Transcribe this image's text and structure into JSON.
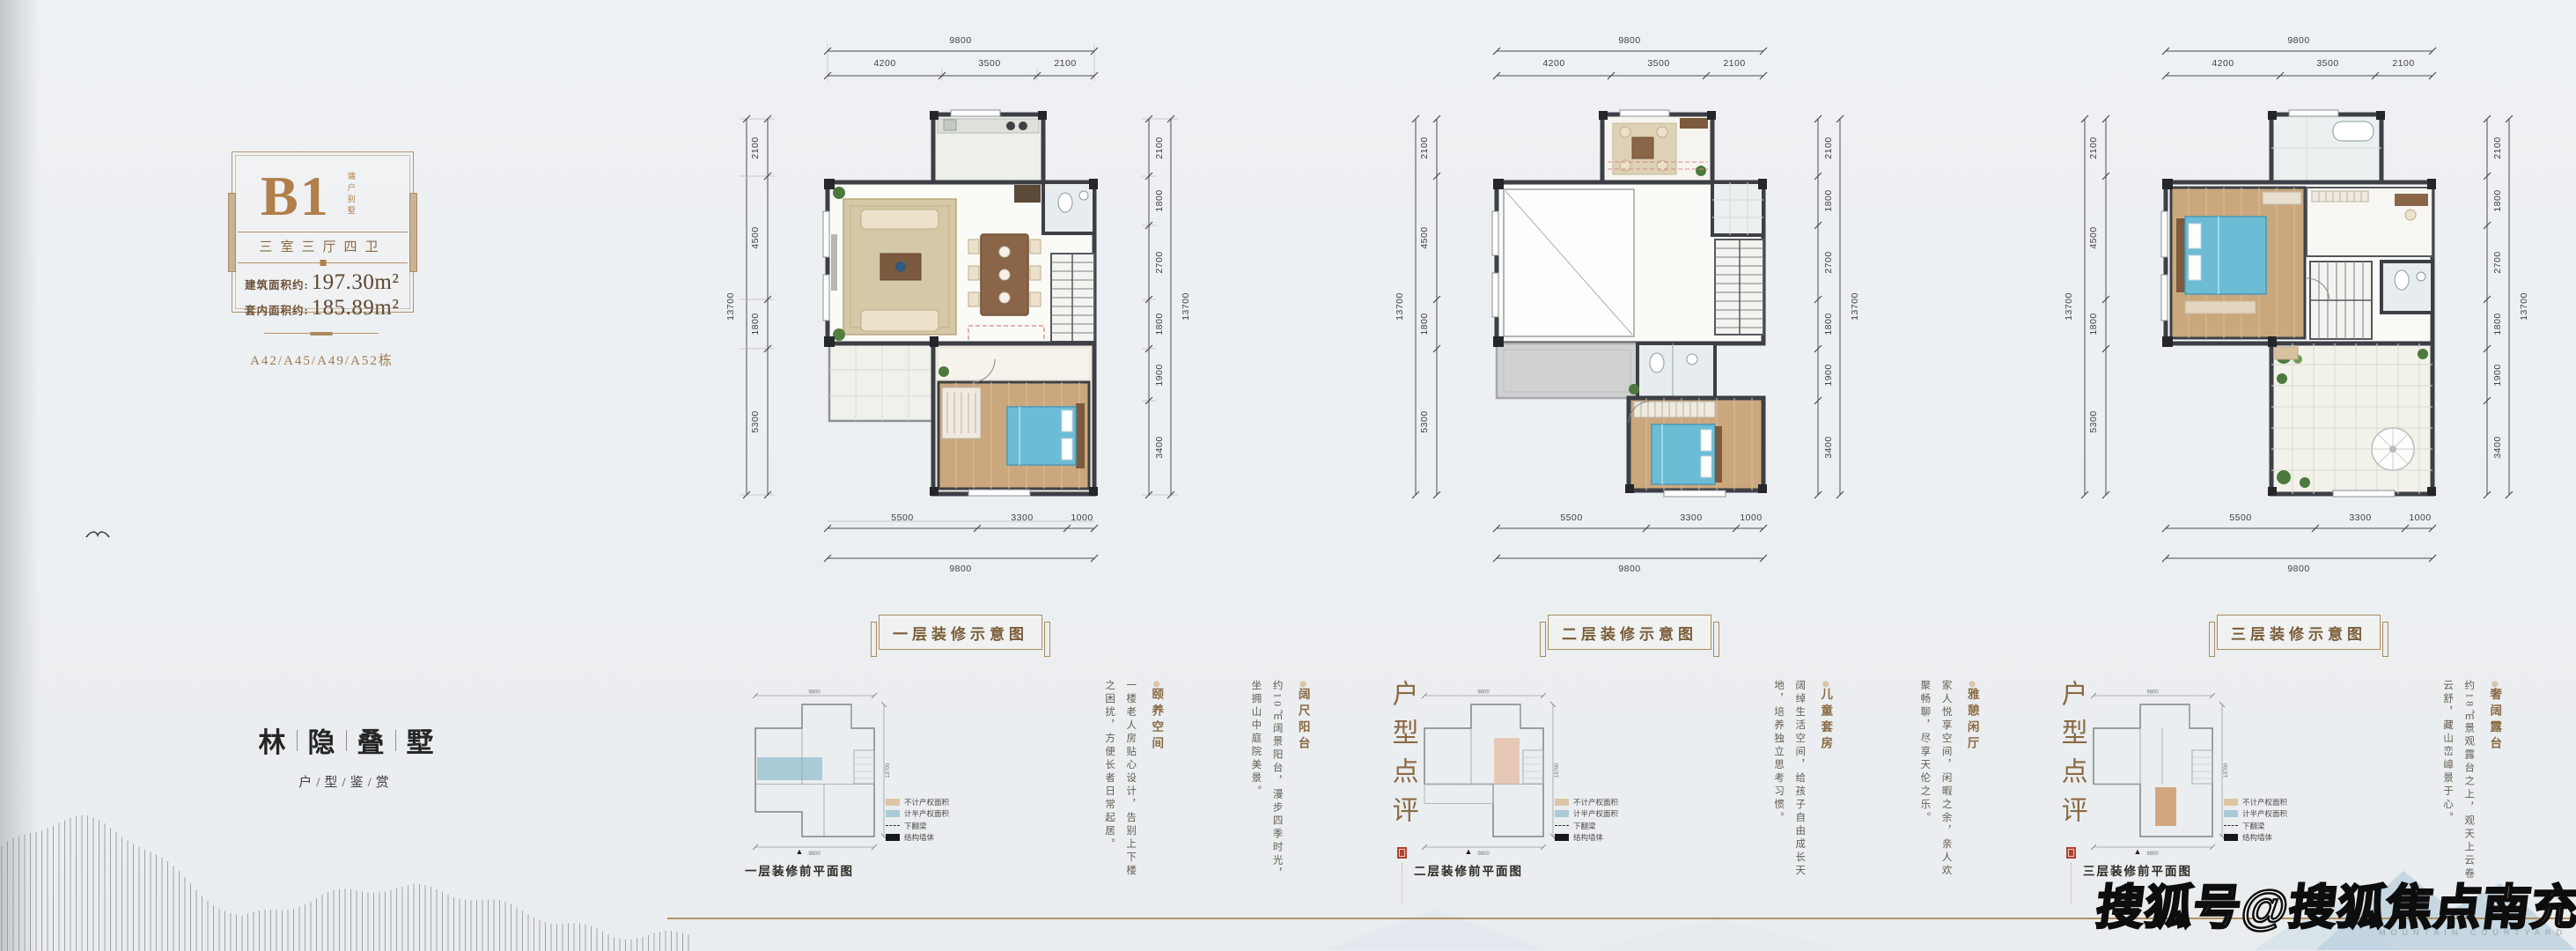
{
  "page": {
    "watermark": "搜狐号@搜狐焦点南充站",
    "bottom_caption": "MOUNTAIN COURTYARD",
    "triangle": "▲",
    "accent_gold": "#b2905f",
    "brand_brown": "#8a6b44",
    "seal_red": "#b4402c",
    "background": "#edf0f2"
  },
  "sidebar": {
    "unit": "B1",
    "unit_tag": "端户别墅",
    "layout": "三室三厅四卫",
    "area_build_label": "建筑面积约:",
    "area_build_value": "197.30m²",
    "area_inner_label": "套内面积约:",
    "area_inner_value": "185.89m²",
    "buildings": "A42/A45/A49/A52栋",
    "brand_chars": [
      "林",
      "隐",
      "叠",
      "墅"
    ],
    "brand_subtitle": "户/型/鉴/赏"
  },
  "dims": {
    "top_total": "9800",
    "top_segments": [
      "4200",
      "3500",
      "2100"
    ],
    "left_total": "13700",
    "left_segments": [
      "2100",
      "4500",
      "1800",
      "5300"
    ],
    "right_total": "13700",
    "right_segments": [
      "2100",
      "1800",
      "2700",
      "1800",
      "1900",
      "3400"
    ],
    "bottom_segments": [
      "5500",
      "3300",
      "1000"
    ],
    "bottom_total": "9800"
  },
  "legend": {
    "items": [
      {
        "swatch": "tan",
        "label": "不计产权面积"
      },
      {
        "swatch": "blue",
        "label": "计半产权面积"
      },
      {
        "swatch": "dash",
        "label": "下翻梁"
      },
      {
        "swatch": "solid",
        "label": "结构墙体"
      }
    ]
  },
  "plans": [
    {
      "caption": "一层装修示意图",
      "small_caption": "一层装修前平面图",
      "review_title": "户型点评",
      "features": [
        {
          "bullet": "◎",
          "title": "阔尺阳台",
          "text": "约10㎡阔景阳台，漫步四季时光，坐拥山中庭院美景。"
        },
        {
          "bullet": "◎",
          "title": "颐养空间",
          "text": "一楼老人房贴心设计，告别上下楼之困扰，方便长者日常起居。"
        }
      ]
    },
    {
      "caption": "二层装修示意图",
      "small_caption": "二层装修前平面图",
      "review_title": "户型点评",
      "features": [
        {
          "bullet": "◎",
          "title": "雅憩闲厅",
          "text": "家人悦享空间，闲暇之余，亲人欢聚畅聊，尽享天伦之乐。"
        },
        {
          "bullet": "◎",
          "title": "儿童套房",
          "text": "阔绰生活空间，给孩子自由成长天地，培养独立思考习惯。"
        }
      ]
    },
    {
      "caption": "三层装修示意图",
      "small_caption": "三层装修前平面图",
      "review_title": "户型点评",
      "features": [
        {
          "bullet": "◎",
          "title": "行政套房",
          "text": "主卧套房步入式衣帽间，独立卫浴设计，大尺度彰显居者气度。"
        },
        {
          "bullet": "◎",
          "title": "奢阔露台",
          "text": "约18㎡景观露台之上，观天上云卷云舒，藏山峦嶂景于心。"
        }
      ]
    }
  ]
}
